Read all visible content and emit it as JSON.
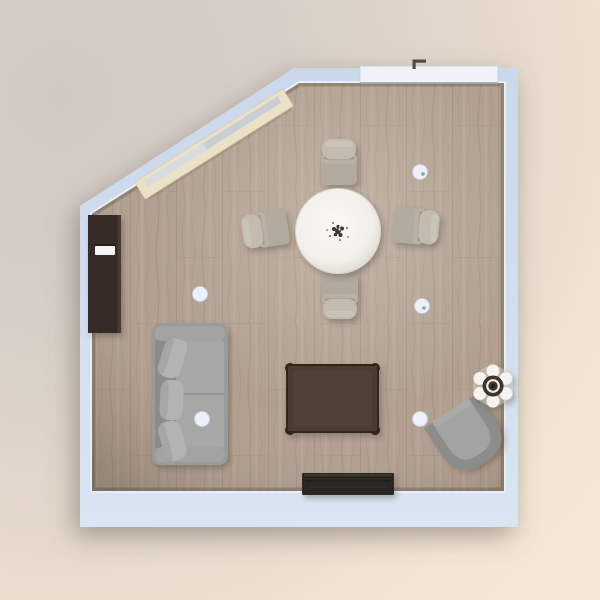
{
  "scene": {
    "view": "floor-plan-top-view",
    "room_label": "living-dining-room",
    "room_shape": "rectangle-with-diagonal-top-left-corner"
  },
  "colors": {
    "wall": "#d2deee",
    "wall_edge": "#e9eff7",
    "floor": "#b1a091",
    "floor_seam": "#9a8875",
    "floor_grain": "#a08e7b",
    "floor_streak": "#c3b2a1",
    "window_frame": "#eae1c6",
    "window_glass": "#c9ced4",
    "door": "#eff2f6",
    "door_handle": "#4e4c48",
    "cabinet": "#342c27",
    "cabinet_drawer": "#f4f4f2",
    "table_top": "#f9f8f4",
    "table_rim": "#d8d4cd",
    "centerpiece_dark": "#3b382f",
    "chair_seat": "#b2ab9d",
    "chair_pillow": "#c2bbae",
    "sofa_frame": "#9a9a98",
    "sofa_back": "#8b8b89",
    "sofa_cushion": "#a7a7a5",
    "sofa_pillow": "#b3b3b1",
    "sofa_armrest": "#a3a3a1",
    "coffee_table": "#4c3b33",
    "coffee_table_edge": "#33261f",
    "coffee_table_knob": "#2e221c",
    "armchair_shell": "#8c8c8a",
    "armchair_seat": "#a2a29f",
    "tv_console": "#2a2723",
    "decor_white": "#f6f4f0",
    "decor_dark": "#3b362f",
    "lamp_dot": "#ecf1f9"
  },
  "furniture": [
    {
      "id": "window",
      "label": "window on diagonal wall",
      "count": 1
    },
    {
      "id": "door",
      "label": "sliding door top wall",
      "count": 1
    },
    {
      "id": "cabinet",
      "label": "tall dark wall cabinet",
      "count": 1
    },
    {
      "id": "dining-table",
      "label": "round white dining table",
      "count": 1
    },
    {
      "id": "dining-chair",
      "label": "upholstered dining chair",
      "count": 4
    },
    {
      "id": "sofa",
      "label": "gray three-seat sofa",
      "count": 1
    },
    {
      "id": "coffee-table",
      "label": "dark wood coffee table",
      "count": 1
    },
    {
      "id": "armchair",
      "label": "gray tub armchair",
      "count": 1
    },
    {
      "id": "decor-set",
      "label": "coffee set on side table",
      "count": 1
    },
    {
      "id": "tv-console",
      "label": "black media console",
      "count": 1
    },
    {
      "id": "ceiling-lamp",
      "label": "ceiling lamp marker",
      "count": 5
    }
  ]
}
